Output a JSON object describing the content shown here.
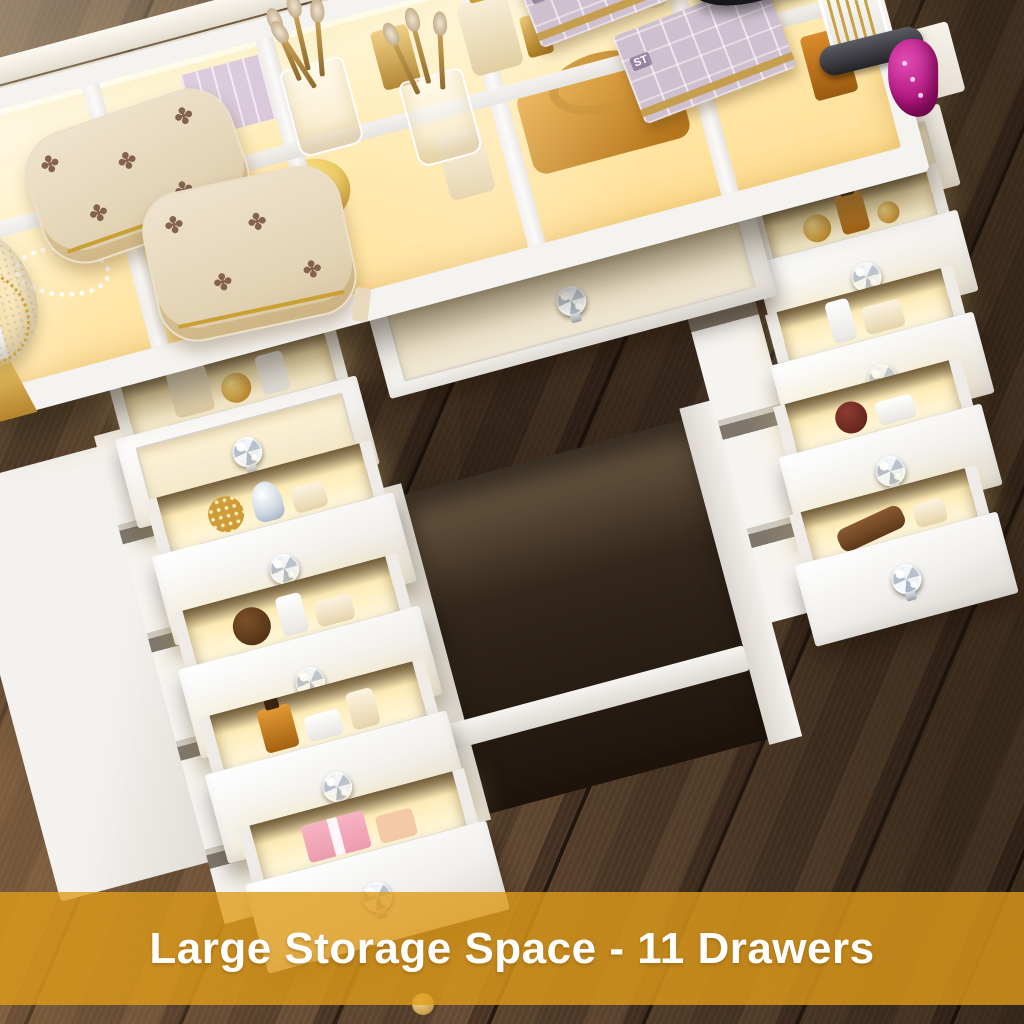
{
  "banner": {
    "text": "Large Storage Space - 11 Drawers",
    "background": "rgba(222,155,26,0.8)",
    "text_color": "#ffffff"
  },
  "storage": {
    "total_drawers": 11,
    "left_pedestal_drawers": 5,
    "right_pedestal_drawers": 5,
    "center_drawers": 1
  },
  "devices": {
    "watch_time": "7:29",
    "phone_status": "charging"
  },
  "labels": {
    "perfume": "COCO",
    "lipstick_box": "ST"
  },
  "icons": {
    "charging_bolt": "⚡",
    "monogram": "✤"
  },
  "colors": {
    "banner_gold": "#DE9B1A",
    "led_glow": "#FFE9A8",
    "desk_white": "#F5F3F0",
    "floor_dark_wood": "#4A3525",
    "hair_tool_magenta": "#B1177F",
    "knob_crystal": "#E9EEF5",
    "charge_green": "#2FD968"
  }
}
